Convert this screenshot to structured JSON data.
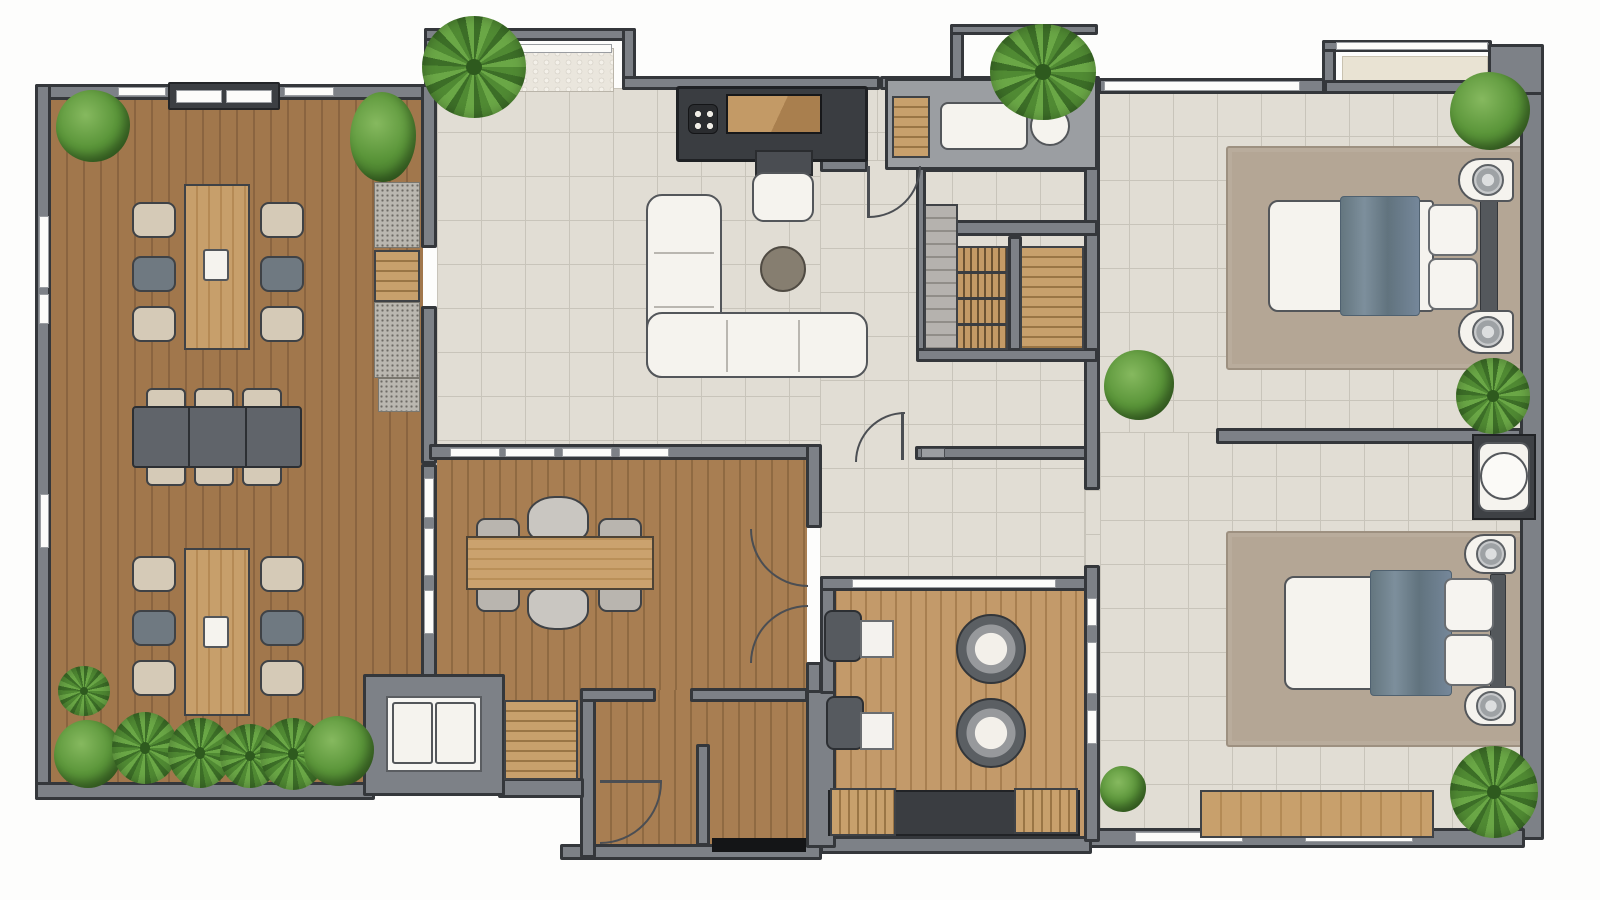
{
  "palette": {
    "wall": "#7d8187",
    "wallDark": "#34373b",
    "winWhite": "#fcfcfa",
    "woodA": "#a1774c",
    "woodALine": "#8a6440",
    "woodB": "#a87e52",
    "woodBLine": "#8f6a42",
    "woodC": "#c39a6a",
    "woodCLine": "#a87f50",
    "tile": "#e1ddd4",
    "tileLine": "#c8c4ba",
    "rug": "#b4a695",
    "rugLine": "#9d9080",
    "whiteF": "#f5f3ee",
    "outline": "#53565a",
    "tableDark": "#60646a",
    "tableWood": "#c8a06c",
    "chairBeige": "#d5cab7",
    "chairGray": "#6f7981",
    "coffeeTable": "#867e70",
    "blanket": "#6e7f8d",
    "greenLight": "#5a9539",
    "greenDark": "#3c6f25",
    "mesh": "#bab7b0",
    "stepGray": "#b5b2ae",
    "thresholdBlack": "#141517",
    "matPebble": "#eae6dd",
    "matBeige": "#e9e3d3",
    "wcBox": "#9b9ea2"
  }
}
